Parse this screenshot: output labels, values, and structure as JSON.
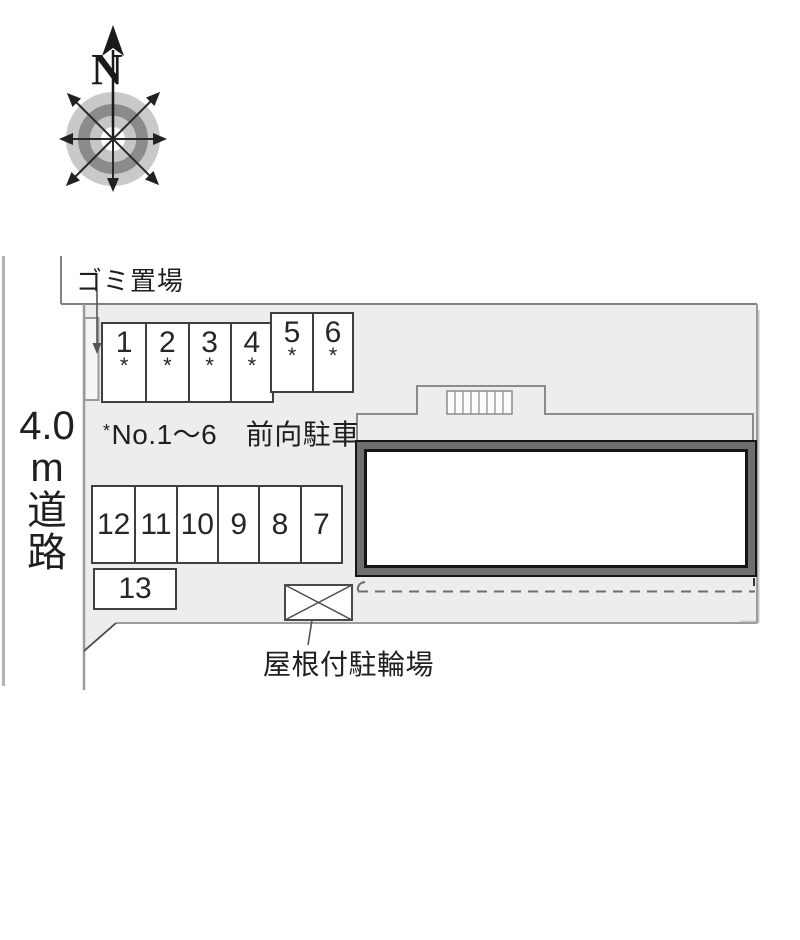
{
  "compass": {
    "north_label": "N"
  },
  "site": {
    "garbage_label": "ゴミ置場",
    "road_label": "4.0\nm\n道\n路",
    "note_bullet": "*",
    "note_text": "No.1〜6　前向駐車",
    "bicycle_label": "屋根付駐輪場",
    "stall_star": "*"
  },
  "stalls": {
    "front_row": [
      "1",
      "2",
      "3",
      "4"
    ],
    "side_row": [
      "5",
      "6"
    ],
    "back_row": [
      "12",
      "11",
      "10",
      "9",
      "8",
      "7"
    ],
    "extra_row": [
      "13"
    ]
  },
  "colors": {
    "site_fill": "#ededed",
    "boundary_line": "#8a8a8a",
    "building_band": "#6f6f6f",
    "building_outline": "#151515",
    "ink": "#1f1f1f"
  }
}
